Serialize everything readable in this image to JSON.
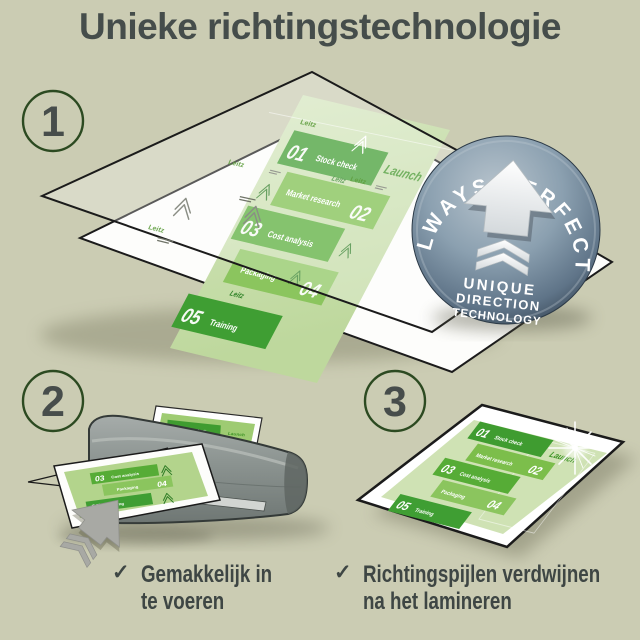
{
  "title": "Unieke richtingstechnologie",
  "step_labels": {
    "step1": "1",
    "step2": "2",
    "step3": "3"
  },
  "brand_mark": "Leitz",
  "infographic": {
    "launch": "Launch",
    "items": [
      {
        "num": "01",
        "label": "Stock check"
      },
      {
        "num": "02",
        "label": "Market research"
      },
      {
        "num": "03",
        "label": "Cost analysis"
      },
      {
        "num": "04",
        "label": "Packaging"
      },
      {
        "num": "05",
        "label": "Training"
      }
    ]
  },
  "badge": {
    "arc": "ALWAYS PERFECT!",
    "lines": [
      "UNIQUE",
      "DIRECTION",
      "TECHNOLOGY"
    ]
  },
  "benefits": [
    {
      "check": "✓",
      "line1": "Gemakkelijk in",
      "line2": "te voeren"
    },
    {
      "check": "✓",
      "line1": "Richtingspijlen verdwijnen",
      "line2": "na het lamineren"
    }
  ],
  "colors": {
    "background": "#cbccb3",
    "title_text": "#454d4b",
    "accent_green_dark": "#3f9c30",
    "accent_green_mid": "#56ac36",
    "accent_green_light": "#8bc55e",
    "doc_green": "#cbdfad",
    "badge_steel": "#7b90a0",
    "machine_gray": "#8b9390"
  }
}
